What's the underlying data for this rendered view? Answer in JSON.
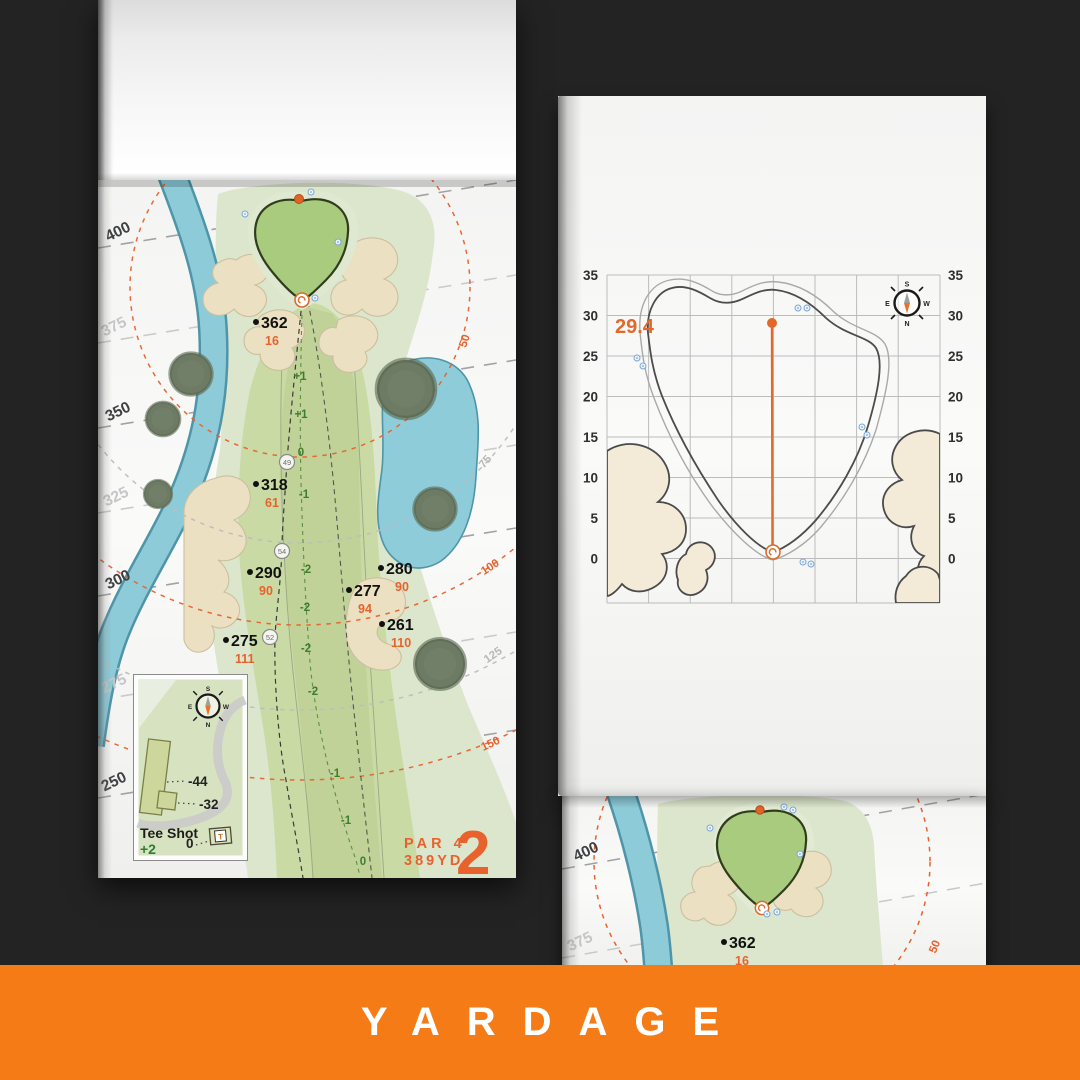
{
  "colors": {
    "accent_orange": "#e8622d",
    "banner_orange": "#f57b17",
    "background": "#232323",
    "fairway_green": "#c9daa4",
    "rough_green": "#dce6cc",
    "putting_green": "#a9cb7d",
    "water_blue": "#8ecbd8",
    "bunker_sand": "#ece0c2"
  },
  "banner": {
    "label": "YARDAGE"
  },
  "compass": {
    "n": "N",
    "s": "S",
    "e": "E",
    "w": "W"
  },
  "hole_page": {
    "hole_number": "2",
    "par_label": "PAR 4",
    "yardage_label": "389YD",
    "side_yardages": [
      {
        "label": "400"
      },
      {
        "label": "375"
      },
      {
        "label": "350"
      },
      {
        "label": "325"
      },
      {
        "label": "300"
      },
      {
        "label": "275"
      },
      {
        "label": "250"
      }
    ],
    "range_rings": [
      {
        "label": "50"
      },
      {
        "label": "75"
      },
      {
        "label": "100"
      },
      {
        "label": "125"
      },
      {
        "label": "150"
      }
    ],
    "markers": [
      {
        "dist": "362",
        "carry": "16"
      },
      {
        "dist": "318",
        "carry": "61"
      },
      {
        "dist": "290",
        "carry": "90"
      },
      {
        "dist": "275",
        "carry": "111"
      },
      {
        "dist": "280",
        "carry": "90"
      },
      {
        "dist": "277",
        "carry": "94"
      },
      {
        "dist": "261",
        "carry": "110"
      }
    ],
    "elevations": [
      "+1",
      "+1",
      "0",
      "-1",
      "-2",
      "-2",
      "-2",
      "-2",
      "-1",
      "-1",
      "0"
    ],
    "waypoints": [
      "49",
      "54",
      "52"
    ],
    "tee_inset": {
      "title": "Tee Shot",
      "shot_elevation": "+2",
      "offsets": [
        "-44",
        "-32",
        "0"
      ],
      "tee_marker": "T"
    }
  },
  "green_page": {
    "depth": "29.4",
    "y_ticks": [
      "35",
      "30",
      "25",
      "20",
      "15",
      "10",
      "5",
      "0"
    ]
  },
  "next_page": {
    "side_yardages": [
      "400",
      "375"
    ],
    "marker": {
      "dist": "362",
      "carry": "16"
    },
    "ring_label": "50"
  }
}
